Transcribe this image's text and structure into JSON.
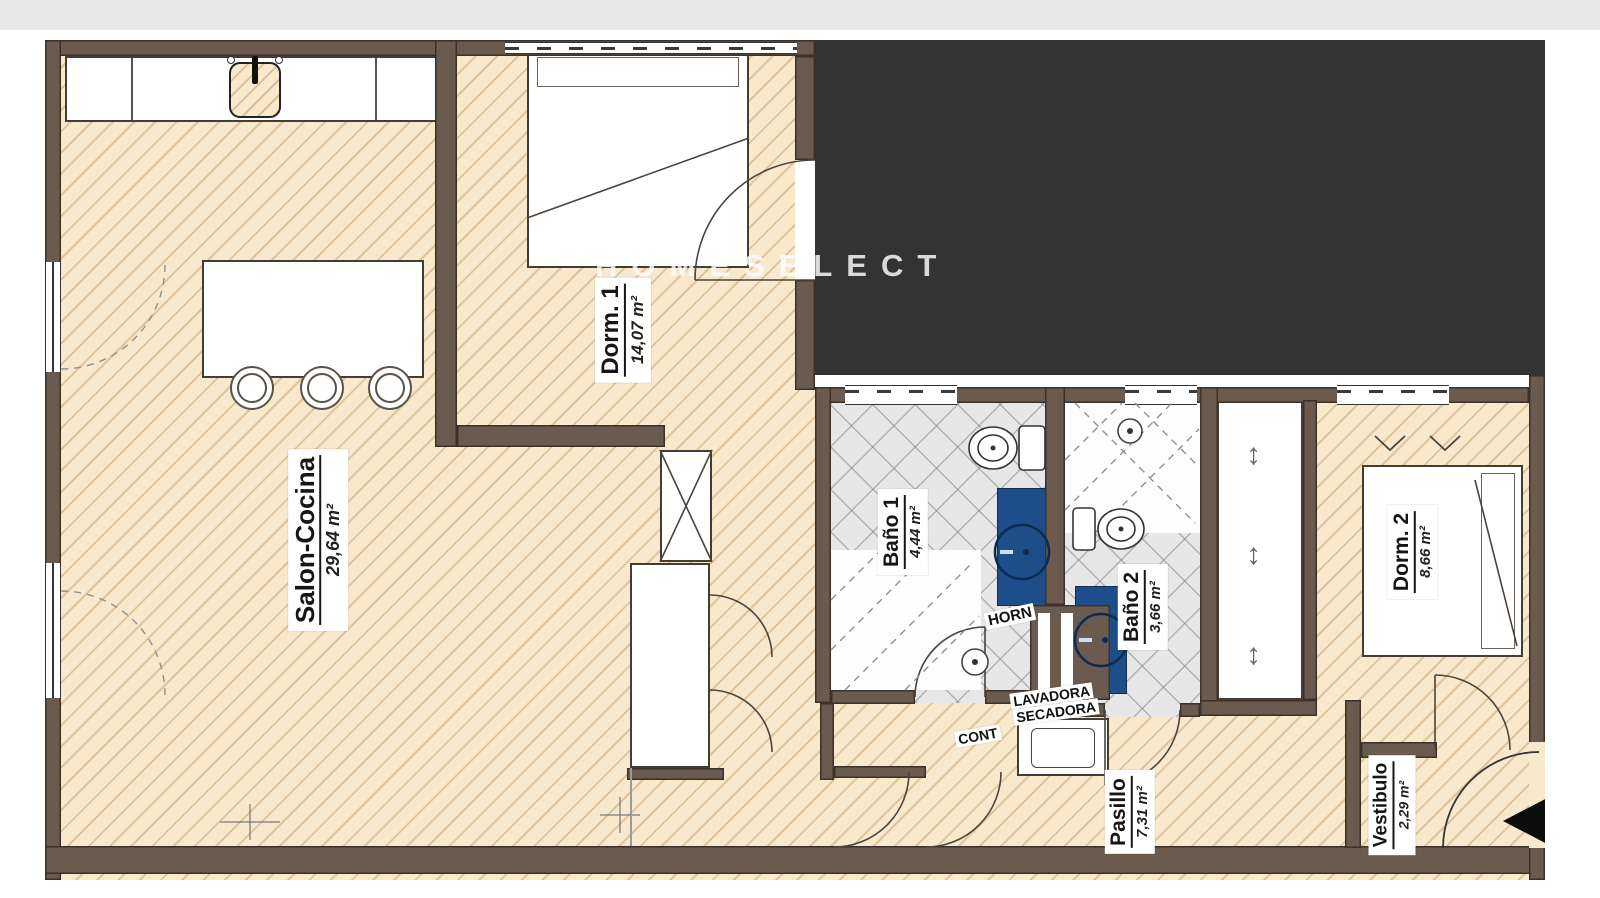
{
  "watermark": {
    "text": "HOMESELECT"
  },
  "rooms": [
    {
      "name": "Salon-Cocina",
      "area": "29,64 m²"
    },
    {
      "name": "Dorm. 1",
      "area": "14,07 m²"
    },
    {
      "name": "Baño 1",
      "area": "4,44 m²"
    },
    {
      "name": "Baño 2",
      "area": "3,66 m²"
    },
    {
      "name": "Dorm. 2",
      "area": "8,66 m²"
    },
    {
      "name": "Pasillo",
      "area": "7,31 m²"
    },
    {
      "name": "Vestibulo",
      "area": "2,29 m²"
    }
  ],
  "labels": {
    "horn": "HORN",
    "lavadora": "LAVADORA",
    "secadora": "SECADORA",
    "cont": "CONT"
  },
  "glyphs": {
    "updown": "↕"
  },
  "colors": {
    "wall": "#6b5b4f",
    "floor": "#f8e9cc",
    "hatch": "#c1945c",
    "bath_floor": "#e7e7e7",
    "vanity_blue": "#1d4e8a",
    "dark_area": "#333333",
    "top_strip": "#e8e8e8"
  }
}
